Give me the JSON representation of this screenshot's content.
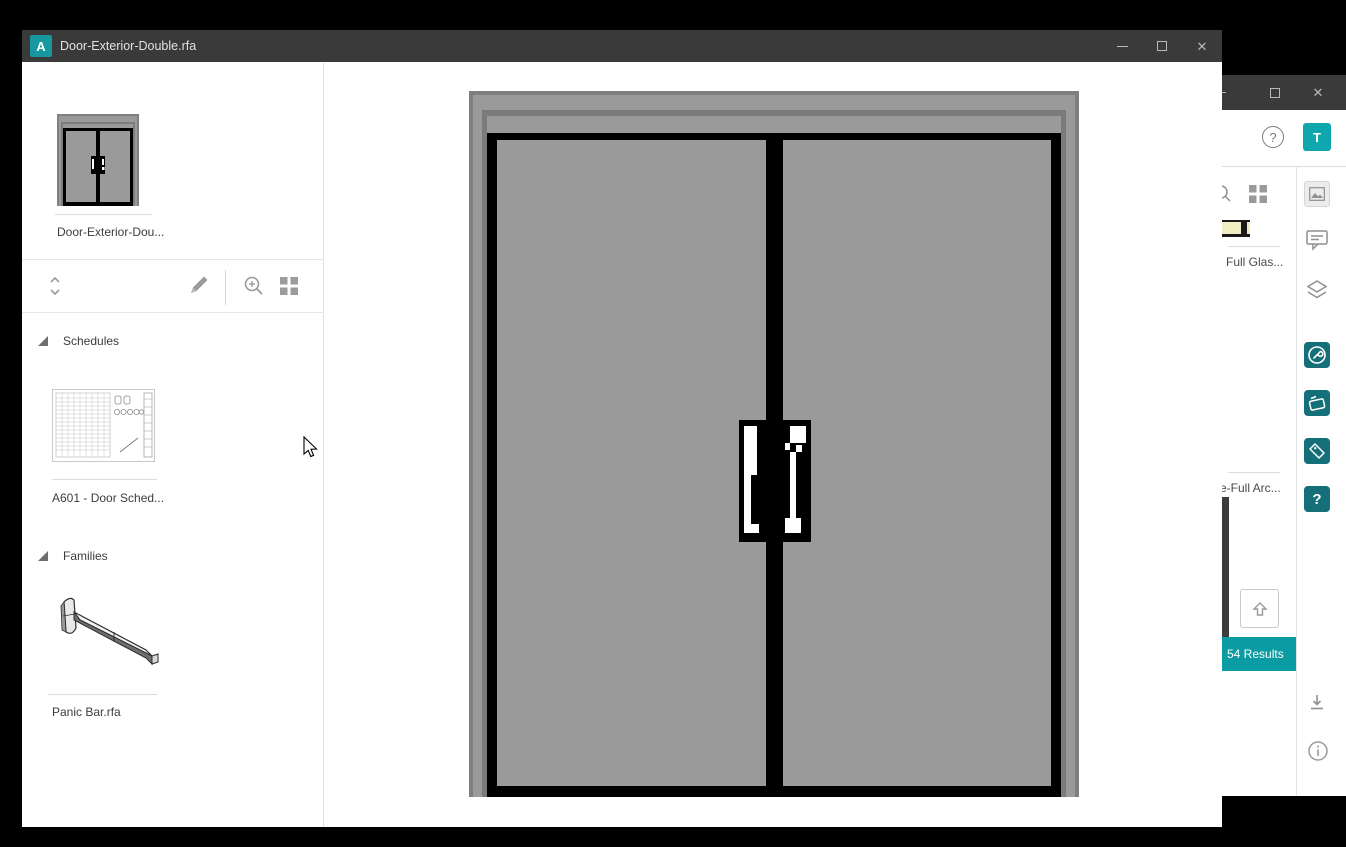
{
  "window": {
    "title": "Door-Exterior-Double.rfa",
    "logo_letter": "A"
  },
  "sidebar": {
    "main_thumb_label": "Door-Exterior-Dou...",
    "sections": [
      {
        "label": "Schedules",
        "items": [
          {
            "label": "A601 - Door Sched..."
          }
        ]
      },
      {
        "label": "Families",
        "items": [
          {
            "label": "Panic Bar.rfa"
          }
        ]
      }
    ]
  },
  "background_window": {
    "avatar_letter": "T",
    "help_glyph": "?",
    "rail_question_glyph": "?",
    "results_badge": "54 Results",
    "result_items": [
      {
        "label": "Full Glas..."
      },
      {
        "label": "e-Full Arc..."
      }
    ]
  },
  "colors": {
    "title_bar": "#3a3a3a",
    "logo_teal": "#17979e",
    "avatar_teal": "#0fa6ad",
    "banner_teal": "#0a9ba3",
    "rail_teal": "#156f78",
    "door_gray": "#9a9a9a",
    "frame_gray": "#7f7f7f"
  }
}
